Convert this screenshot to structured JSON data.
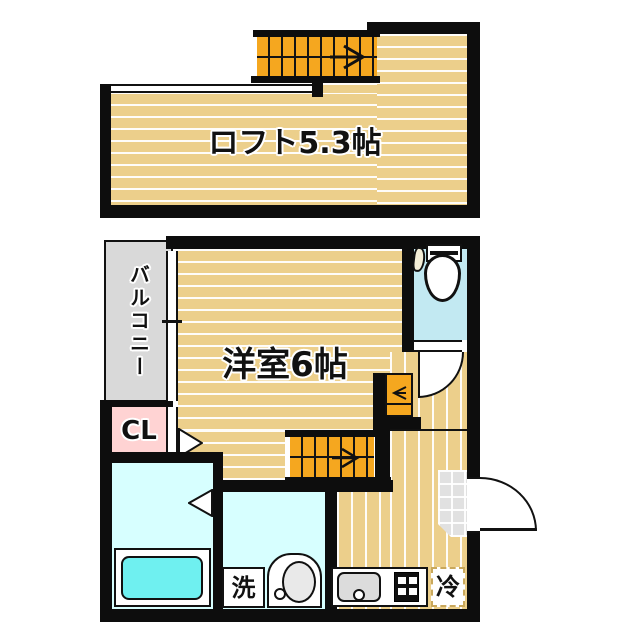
{
  "floorplan": {
    "labels": {
      "loft": "ロフト5.3帖",
      "room": "洋室6帖",
      "balcony": "バルコニー",
      "closet": "CL",
      "washing_machine": "洗",
      "refrigerator": "冷"
    },
    "colors": {
      "wall": "#0d0d0d",
      "floor_tan": "#ECCF8B",
      "stairs_orange": "#F5A71F",
      "balcony_gray": "#D9D9D9",
      "closet_pink": "#FFD3D3",
      "toilet_cyan": "#C2E9F2",
      "bath_cyan": "#D7FFFF",
      "tub_cyan": "#6FF0F0",
      "genkan_gray": "#E1E1E1",
      "fridge_dash": "#C9A85C"
    }
  }
}
